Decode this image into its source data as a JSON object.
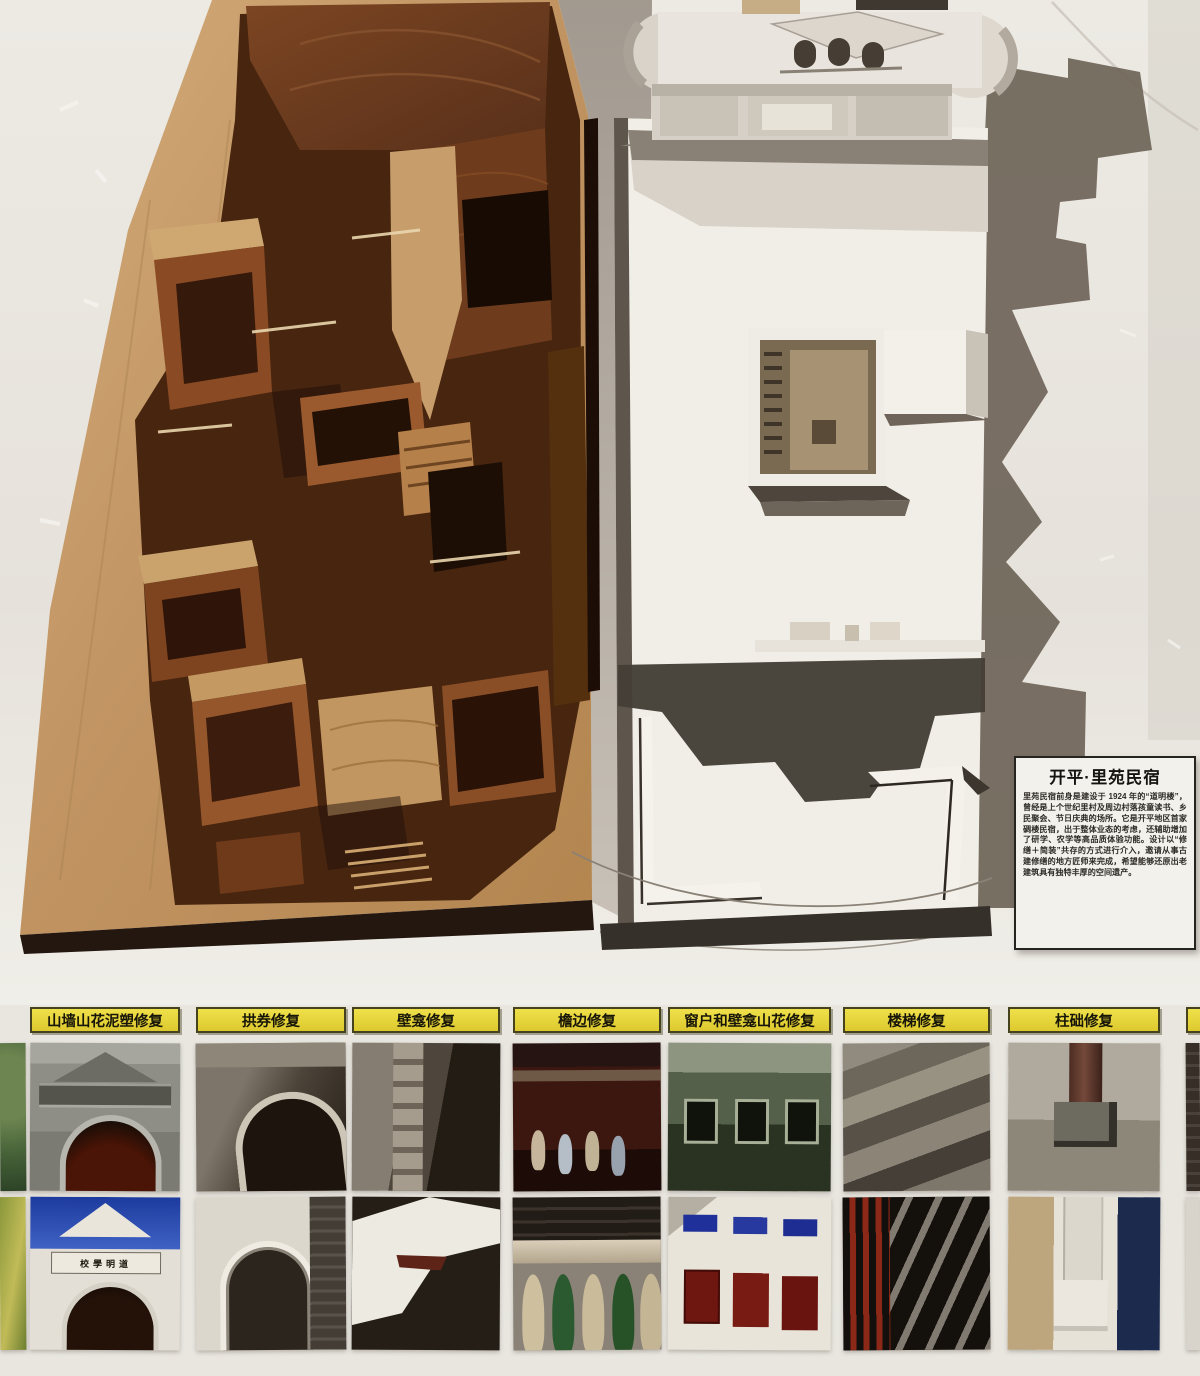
{
  "info_card": {
    "title": "开平·里苑民宿",
    "body": "里苑民宿前身是建设于 1924 年的“道明楼”，曾经是上个世纪里村及周边村落孩童读书、乡民聚会、节日庆典的场所。它是开平地区首家碉楼民宿，出于整体业态的考虑，还辅助增加了研学、农学等高品质体验功能。设计以“修缮＋简装”共存的方式进行介入，邀请从事古建修缮的地方匠师来完成，希望能够还原出老建筑具有独特丰厚的空间遗产。"
  },
  "restoration": {
    "items": [
      {
        "label": "山墙山花泥塑修复"
      },
      {
        "label": "拱券修复"
      },
      {
        "label": "壁龛修复"
      },
      {
        "label": "檐边修复"
      },
      {
        "label": "窗户和壁龛山花修复"
      },
      {
        "label": "楼梯修复"
      },
      {
        "label": "柱础修复"
      }
    ],
    "gate_plaque": "校學明道"
  },
  "palette": {
    "label_yellow": "#e3cf2e",
    "wall": "#e9e6e0",
    "wood_light": "#c9a16b",
    "wood_dark": "#5a2f16",
    "model_white": "#f1eee8",
    "shadow_brown": "#6e6458"
  }
}
